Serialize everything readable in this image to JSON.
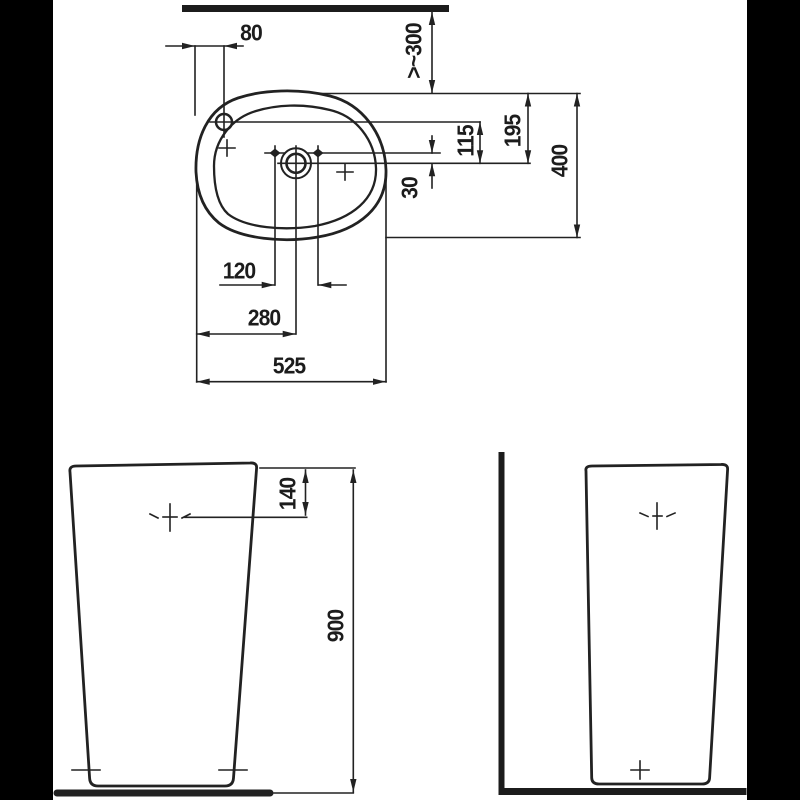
{
  "drawing": {
    "kind": "washbasin technical dimension drawing",
    "colors": {
      "ink": "#222222",
      "background": "#ffffff",
      "pillarbox": "#000000"
    }
  },
  "plan_view": {
    "dim_tap_from_left_edge": "80",
    "dim_wall_clearance": ">~300",
    "dim_rear_to_drain": "195",
    "dim_taphole_to_drain": "115",
    "dim_sidehole_to_drain": "30",
    "dim_overall_depth": "400",
    "dim_sidehole_spacing": "120",
    "dim_left_edge_to_drain": "280",
    "dim_overall_width": "525"
  },
  "front_view": {
    "dim_rim_to_fixing": "140",
    "dim_overall_height": "900"
  }
}
